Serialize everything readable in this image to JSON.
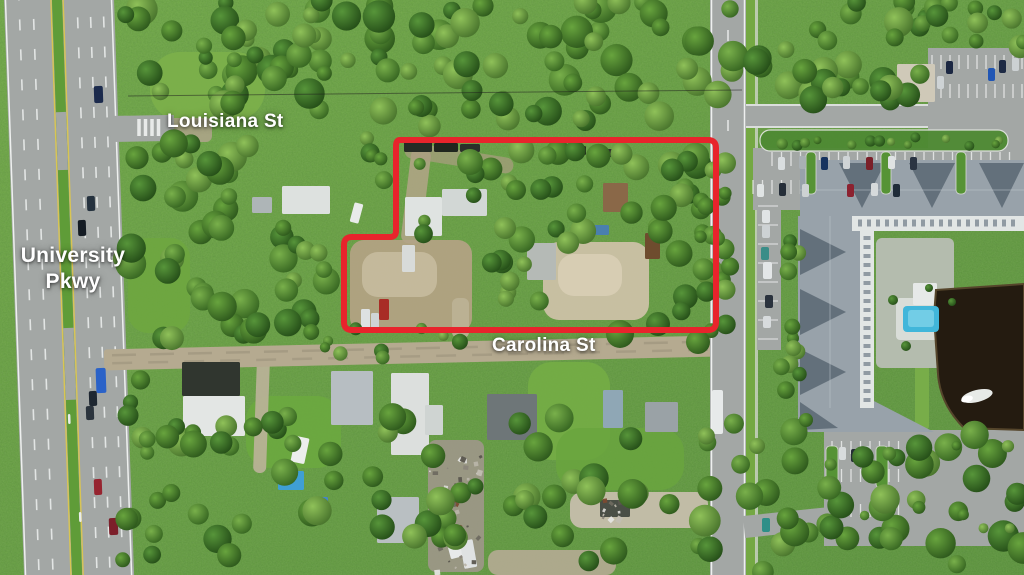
{
  "labels": {
    "louisiana": "Louisiana St",
    "university_line1": "University",
    "university_line2": "Pkwy",
    "carolina": "Carolina St"
  },
  "colors": {
    "boundary": "#e8242c",
    "label": "#ffffff",
    "asphalt": "#a3a7a5",
    "median": "#5f9c38",
    "dirt": "#b5aa90",
    "roof": "#98a2aa",
    "roof_dark": "#5d6a75",
    "white_struct": "#e2e6e5",
    "pond": "#241b10",
    "pool": "#41b6da",
    "line_white": "#eef0ef",
    "line_yellow": "#d9c553",
    "hedge": "#4e8a33",
    "verge": "#74a843"
  },
  "parcel": {
    "path": "M 400 140 L 708 140 Q 716 140 716 148 L 716 322 Q 716 330 708 330 L 352 330 Q 344 330 344 322 L 344 245 Q 344 237 352 237 L 390 237 Q 396 237 396 231 L 396 146 Q 396 140 400 140 Z"
  },
  "scene": {
    "patches": [
      [
        150,
        52,
        115,
        68,
        30,
        0,
        0.9,
        "#7cb04a"
      ],
      [
        128,
        238,
        62,
        95,
        20,
        0,
        0.85,
        "#6fa73f"
      ],
      [
        246,
        396,
        95,
        72,
        24,
        0,
        0.9,
        "#6ca83f"
      ],
      [
        528,
        362,
        82,
        98,
        24,
        0,
        0.9,
        "#74ad45"
      ],
      [
        556,
        428,
        128,
        62,
        24,
        0,
        0.85,
        "#6aa53e"
      ],
      [
        350,
        240,
        122,
        92,
        14,
        0,
        0.95,
        "#b2a283"
      ],
      [
        362,
        252,
        75,
        45,
        16,
        0,
        0.9,
        "#c7bb9f"
      ],
      [
        543,
        242,
        106,
        78,
        16,
        0,
        0.95,
        "#ccc1a7"
      ],
      [
        558,
        254,
        64,
        42,
        16,
        0,
        0.9,
        "#d8ceb5"
      ],
      [
        406,
        148,
        20,
        96,
        8,
        7,
        0.85,
        "#b3a488"
      ],
      [
        404,
        150,
        110,
        16,
        8,
        9,
        0.7,
        "#ab9d82"
      ],
      [
        452,
        298,
        17,
        40,
        6,
        0,
        0.9,
        "#bdb296"
      ],
      [
        255,
        358,
        13,
        115,
        6,
        2,
        0.9,
        "#bdb39a"
      ],
      [
        570,
        492,
        138,
        36,
        12,
        0,
        0.95,
        "#c6beac"
      ],
      [
        488,
        550,
        128,
        25,
        10,
        0,
        0.9,
        "#b5ab93"
      ],
      [
        168,
        118,
        44,
        24,
        6,
        0,
        0.85,
        "#b0a58c"
      ],
      [
        915,
        288,
        14,
        142,
        4,
        0,
        1,
        "#78ad49"
      ],
      [
        876,
        238,
        78,
        130,
        6,
        0,
        1,
        "#b4bcae"
      ],
      [
        896,
        298,
        52,
        42,
        4,
        0,
        1,
        "#d9ddd8"
      ],
      [
        428,
        440,
        56,
        132,
        8,
        0,
        0.9,
        "#9e978a"
      ]
    ],
    "structures": [
      [
        282,
        186,
        48,
        28,
        0,
        "#dde1df"
      ],
      [
        252,
        197,
        20,
        16,
        0,
        "#aeb5b7"
      ],
      [
        352,
        203,
        9,
        20,
        15,
        "#e9ebea"
      ],
      [
        404,
        142,
        28,
        10,
        0,
        "#262b25"
      ],
      [
        434,
        143,
        24,
        9,
        0,
        "#20261e"
      ],
      [
        460,
        144,
        20,
        8,
        0,
        "#2b302a"
      ],
      [
        556,
        146,
        30,
        9,
        0,
        "#23291f"
      ],
      [
        592,
        149,
        22,
        8,
        0,
        "#2e332c"
      ],
      [
        405,
        197,
        37,
        39,
        0,
        "#dfe3e1"
      ],
      [
        442,
        189,
        45,
        27,
        0,
        "#d2d7d5"
      ],
      [
        603,
        183,
        25,
        29,
        0,
        "#8a6848"
      ],
      [
        592,
        225,
        17,
        10,
        0,
        "#4a7fae"
      ],
      [
        527,
        243,
        29,
        37,
        0,
        "#b5bab6"
      ],
      [
        645,
        233,
        15,
        26,
        0,
        "#6e4c2e"
      ],
      [
        402,
        245,
        13,
        27,
        0,
        "#d8dbd9"
      ],
      [
        379,
        299,
        10,
        21,
        0,
        "#a82d26"
      ],
      [
        361,
        309,
        9,
        19,
        0,
        "#dde1e2"
      ],
      [
        371,
        313,
        8,
        17,
        0,
        "#cfd4d5"
      ],
      [
        182,
        362,
        58,
        34,
        0,
        "#30362f"
      ],
      [
        183,
        396,
        62,
        40,
        0,
        "#e3e6e4"
      ],
      [
        331,
        371,
        42,
        54,
        0,
        "#b7bec2"
      ],
      [
        391,
        373,
        38,
        82,
        0,
        "#dcdfdd"
      ],
      [
        425,
        405,
        18,
        30,
        0,
        "#cfd4d2"
      ],
      [
        293,
        437,
        14,
        26,
        12,
        "#eceeed"
      ],
      [
        278,
        471,
        26,
        19,
        0,
        "#3f9fd4"
      ],
      [
        312,
        497,
        16,
        12,
        0,
        "#4587c8"
      ],
      [
        487,
        394,
        50,
        46,
        0,
        "#6e7678"
      ],
      [
        603,
        390,
        20,
        38,
        0,
        "#8fa7b5"
      ],
      [
        645,
        402,
        33,
        30,
        0,
        "#9aa2a6"
      ],
      [
        377,
        497,
        42,
        46,
        0,
        "#b9bfc2"
      ],
      [
        600,
        500,
        30,
        17,
        0,
        "#4a4f46"
      ],
      [
        447,
        528,
        14,
        30,
        -15,
        "#e8eaea"
      ],
      [
        462,
        540,
        13,
        28,
        -10,
        "#dfe2e2"
      ],
      [
        897,
        64,
        38,
        38,
        0,
        "#cfc9b8"
      ],
      [
        913,
        283,
        24,
        22,
        0,
        "#e6e9e8"
      ],
      [
        68,
        414,
        2.5,
        10,
        -2,
        "#e9ecec"
      ],
      [
        79,
        512,
        2.5,
        10,
        -2,
        "#e9ecec"
      ]
    ],
    "gables": [
      "839,163 885,163 862,208",
      "909,163 955,163 932,208",
      "979,163 1024,163 1002,208",
      "800,229 800,275 846,252",
      "800,289 800,335 846,312",
      "800,349 800,395 846,372",
      "800,402 800,430 838,428"
    ],
    "stall_rows": [
      [
        932,
        55,
        11,
        9,
        14,
        "v",
        1.3,
        0.8
      ],
      [
        932,
        84,
        11,
        9,
        14,
        "v",
        1.3,
        0.8
      ],
      [
        772,
        152,
        26,
        9.5,
        14,
        "v",
        1.3,
        0.8
      ],
      [
        753,
        180,
        28,
        9.5,
        14,
        "v",
        1.3,
        0.8
      ],
      [
        832,
        441,
        8,
        9.5,
        13,
        "v",
        1.3,
        0.8
      ],
      [
        832,
        469,
        8,
        9.5,
        13,
        "v",
        1.3,
        0.8
      ],
      [
        832,
        504,
        8,
        9.5,
        13,
        "v",
        1.3,
        0.8
      ],
      [
        758,
        206,
        8,
        19,
        20,
        "h",
        1.3,
        0.7
      ],
      [
        139,
        119,
        4,
        6.5,
        17,
        "v",
        3.5,
        0.92
      ]
    ],
    "cars": [
      [
        94,
        86,
        9,
        17,
        -2,
        "#1b2a4c"
      ],
      [
        87,
        196,
        8,
        15,
        -2,
        "#25323e"
      ],
      [
        78,
        220,
        8,
        16,
        -2,
        "#141b23"
      ],
      [
        96,
        368,
        10,
        25,
        -2,
        "#2a62c8"
      ],
      [
        89,
        391,
        8,
        15,
        -2,
        "#1e2731"
      ],
      [
        86,
        406,
        8,
        14,
        -2,
        "#2b343d"
      ],
      [
        94,
        479,
        8,
        16,
        -2,
        "#96242f"
      ],
      [
        109,
        518,
        9,
        17,
        -2,
        "#7c1f2a"
      ],
      [
        712,
        390,
        11,
        44,
        0,
        "#e7eaea"
      ],
      [
        762,
        210,
        8,
        13,
        0,
        "#e0e4e5"
      ],
      [
        762,
        225,
        8,
        13,
        0,
        "#cdd2d4"
      ],
      [
        761,
        247,
        8,
        13,
        0,
        "#3a8d88"
      ],
      [
        763,
        262,
        9,
        17,
        0,
        "#e3e6e7"
      ],
      [
        765,
        295,
        8,
        13,
        0,
        "#2a323d"
      ],
      [
        763,
        316,
        8,
        12,
        0,
        "#d7dbdd"
      ],
      [
        937,
        76,
        7,
        13,
        0,
        "#ced3d5"
      ],
      [
        946,
        61,
        7,
        13,
        0,
        "#1b2742"
      ],
      [
        988,
        68,
        7,
        13,
        0,
        "#2156b4"
      ],
      [
        999,
        60,
        7,
        13,
        0,
        "#1d2a44"
      ],
      [
        1012,
        58,
        7,
        13,
        0,
        "#ccd1d3"
      ],
      [
        778,
        157,
        7,
        13,
        0,
        "#d9dedf"
      ],
      [
        799,
        156,
        7,
        13,
        0,
        "#a9b0b4"
      ],
      [
        821,
        157,
        7,
        13,
        0,
        "#16335f"
      ],
      [
        843,
        156,
        7,
        13,
        0,
        "#cfd4d6"
      ],
      [
        866,
        157,
        7,
        13,
        0,
        "#7b2029"
      ],
      [
        888,
        156,
        7,
        13,
        0,
        "#dfe3e3"
      ],
      [
        910,
        157,
        7,
        13,
        0,
        "#2a3442"
      ],
      [
        757,
        184,
        7,
        13,
        0,
        "#e0e4e4"
      ],
      [
        779,
        183,
        7,
        13,
        0,
        "#252e38"
      ],
      [
        802,
        184,
        7,
        13,
        0,
        "#cdd2d3"
      ],
      [
        847,
        184,
        7,
        13,
        0,
        "#8c2230"
      ],
      [
        871,
        183,
        7,
        13,
        0,
        "#d6dadb"
      ],
      [
        893,
        184,
        7,
        13,
        0,
        "#1f2c39"
      ],
      [
        839,
        447,
        7,
        13,
        0,
        "#d8dcdd"
      ],
      [
        851,
        449,
        7,
        13,
        0,
        "#242d35"
      ],
      [
        863,
        446,
        7,
        13,
        0,
        "#c9ced0"
      ],
      [
        762,
        518,
        8,
        14,
        0,
        "#2e8f88"
      ]
    ],
    "tree_palette_note": "tg0 light-mid, tg1 mid, tg2 light, tg3 dark",
    "tree_clusters": [
      [
        125,
        0,
        262,
        112,
        46,
        7,
        16,
        11
      ],
      [
        378,
        0,
        356,
        132,
        62,
        8,
        17,
        22
      ],
      [
        748,
        0,
        180,
        104,
        34,
        8,
        15,
        33
      ],
      [
        118,
        128,
        130,
        210,
        34,
        8,
        16,
        44
      ],
      [
        250,
        225,
        95,
        115,
        16,
        8,
        15,
        45
      ],
      [
        476,
        148,
        240,
        95,
        22,
        8,
        15,
        55
      ],
      [
        650,
        150,
        66,
        175,
        14,
        8,
        14,
        56
      ],
      [
        480,
        250,
        60,
        70,
        8,
        7,
        12,
        57
      ],
      [
        348,
        138,
        130,
        96,
        10,
        6,
        11,
        66
      ],
      [
        148,
        415,
        600,
        150,
        60,
        8,
        15,
        77
      ],
      [
        116,
        338,
        66,
        226,
        13,
        7,
        12,
        88
      ],
      [
        698,
        425,
        326,
        148,
        44,
        8,
        16,
        99
      ],
      [
        318,
        326,
        165,
        36,
        9,
        5,
        9,
        101
      ],
      [
        698,
        145,
        34,
        190,
        18,
        6,
        11,
        113
      ],
      [
        764,
        136,
        240,
        10,
        14,
        4,
        6,
        114
      ],
      [
        780,
        215,
        22,
        180,
        12,
        6,
        9,
        115
      ],
      [
        828,
        444,
        190,
        96,
        9,
        4,
        7,
        116
      ],
      [
        918,
        0,
        106,
        50,
        13,
        7,
        12,
        118
      ]
    ],
    "trees": [
      [
        620,
        334,
        14,
        1
      ],
      [
        658,
        324,
        12,
        3
      ],
      [
        698,
        342,
        12,
        1
      ],
      [
        470,
        162,
        13,
        0
      ],
      [
        505,
        228,
        11,
        2
      ],
      [
        516,
        190,
        10,
        1
      ],
      [
        893,
        300,
        5,
        3
      ],
      [
        906,
        346,
        5,
        3
      ],
      [
        929,
        288,
        4,
        3
      ],
      [
        952,
        302,
        4,
        3
      ],
      [
        806,
        420,
        7,
        1
      ],
      [
        757,
        446,
        8,
        2
      ]
    ],
    "junk": [
      [
        428,
        442,
        54,
        128,
        46,
        201
      ],
      [
        598,
        497,
        36,
        20,
        10,
        202
      ]
    ],
    "junk_palette": [
      "#d8d8d4",
      "#b8b4a8",
      "#8a857a",
      "#6e6a60",
      "#c2beb2",
      "#5a564e",
      "#e4e4e0",
      "#7a4a32"
    ],
    "pond_path": "M 936 290 L 1024 284 L 1024 430 L 964 428 Q 940 404 938 374 L 934 316 Z"
  }
}
